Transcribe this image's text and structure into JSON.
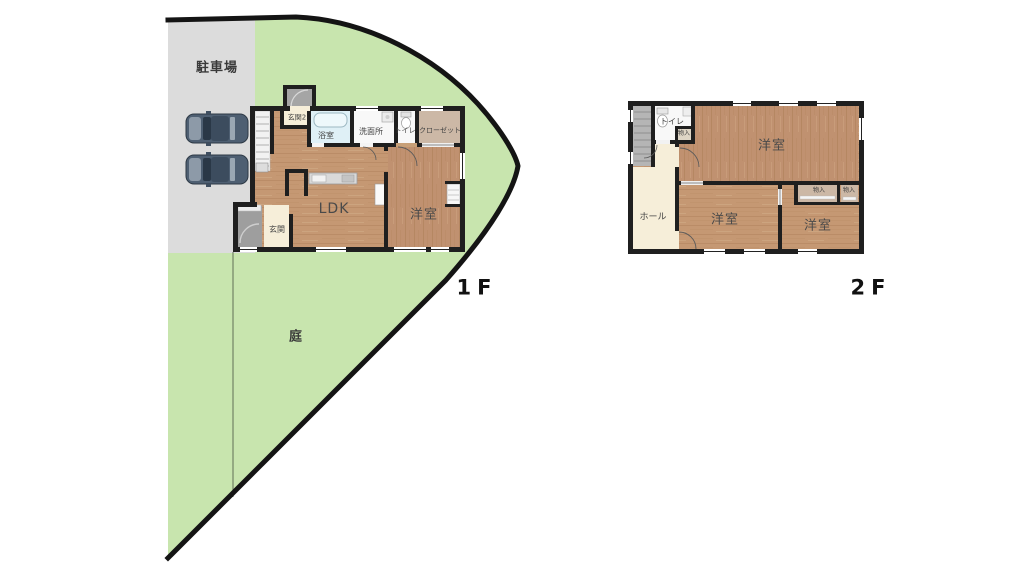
{
  "palette": {
    "site_green": "#c8e5ae",
    "parking_gray": "#dcdcdc",
    "wall_black": "#1f1f1f",
    "wood_floor": "#c59873",
    "bath_blue": "#dff0f6",
    "cream_floor": "#f6eed9",
    "closet_tan": "#ccb8a6",
    "porch_gray": "#9e9e9e",
    "car_body": "#4e5f72"
  },
  "floor1": {
    "floor_label": "1F",
    "site": {
      "parking_label": "駐車場",
      "garden_label": "庭",
      "car_count": 2
    },
    "rooms": {
      "genkan2": "玄関2",
      "bathroom": "浴室",
      "washroom": "洗面所",
      "toilet": "トイレ",
      "closet": "クローゼット",
      "ldk": "LDK",
      "western_room": "洋室",
      "genkan": "玄関"
    }
  },
  "floor2": {
    "floor_label": "2F",
    "rooms": {
      "toilet": "トイレ",
      "storage_top": "物入",
      "hall": "ホール",
      "western_room_main": "洋室",
      "western_room_b": "洋室",
      "western_room_c": "洋室",
      "storage_b": "物入",
      "storage_c": "物入"
    }
  }
}
